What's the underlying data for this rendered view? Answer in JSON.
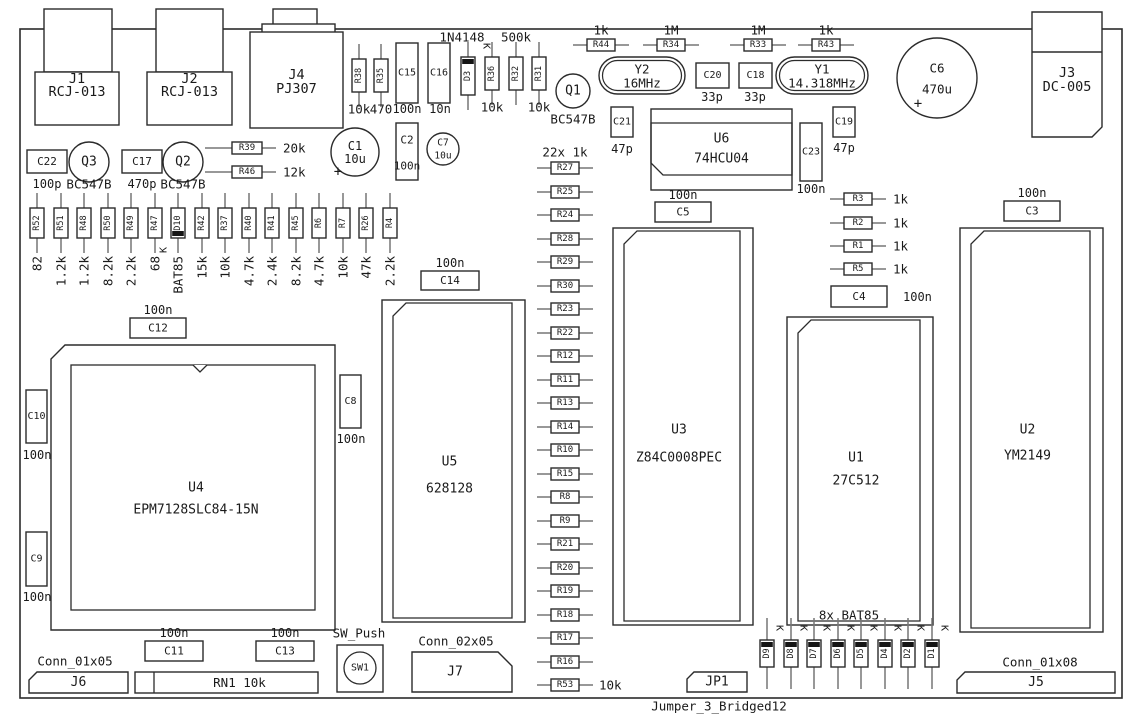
{
  "diagram_title": "PCB assembly drawing",
  "symbols": {
    "cathode": "K",
    "plus": "+"
  },
  "board": {
    "x": 20,
    "y": 29,
    "w": 1102,
    "h": 669
  },
  "notes": [
    {
      "x": 565,
      "y": 152,
      "t": "22x 1k"
    },
    {
      "x": 849,
      "y": 615,
      "t": "8x BAT85"
    },
    {
      "x": 359,
      "y": 633,
      "t": "SW_Push"
    },
    {
      "x": 75,
      "y": 661,
      "t": "Conn_01x05"
    },
    {
      "x": 456,
      "y": 641,
      "t": "Conn_02x05"
    },
    {
      "x": 1040,
      "y": 662,
      "t": "Conn_01x08"
    },
    {
      "x": 719,
      "y": 706,
      "t": "Jumper_3_Bridged12"
    }
  ],
  "components": [
    {
      "t": "ich",
      "ref": "U6",
      "val": "74HCU04",
      "x": 651,
      "y": 109,
      "w": 141,
      "h": 81,
      "iy1": 123,
      "iy2": 175,
      "ry": 139,
      "vy": 159
    },
    {
      "t": "icv",
      "ref": "U3",
      "val": "Z84C0008PEC",
      "x": 613,
      "y": 228,
      "w": 140,
      "h": 397,
      "ry": 430,
      "vy": 458
    },
    {
      "t": "icv",
      "ref": "U1",
      "val": "27C512",
      "x": 787,
      "y": 317,
      "w": 146,
      "h": 308,
      "ry": 458,
      "vy": 481
    },
    {
      "t": "icv",
      "ref": "U2",
      "val": "YM2149",
      "x": 960,
      "y": 228,
      "w": 143,
      "h": 404,
      "ry": 430,
      "vy": 456
    },
    {
      "t": "icv",
      "ref": "U5",
      "val": "628128",
      "x": 382,
      "y": 300,
      "w": 143,
      "h": 322,
      "ry": 462,
      "vy": 489
    },
    {
      "t": "plcc",
      "ref": "U4",
      "val": "EPM7128SLC84-15N",
      "x": 51,
      "y": 345,
      "w": 284,
      "h": 285,
      "ry": 488,
      "vy": 510
    },
    {
      "t": "rcj",
      "ref": "J1",
      "val": "RCJ-013",
      "tab": [
        44,
        9,
        68,
        63
      ],
      "body": [
        35,
        72,
        84,
        53
      ],
      "ry": 79,
      "vy": 92
    },
    {
      "t": "rcj",
      "ref": "J2",
      "val": "RCJ-013",
      "tab": [
        156,
        9,
        67,
        63
      ],
      "body": [
        147,
        72,
        85,
        53
      ],
      "ry": 79,
      "vy": 92
    },
    {
      "t": "pj",
      "ref": "J4",
      "val": "PJ307",
      "tab": [
        273,
        9,
        44,
        16
      ],
      "flange": [
        262,
        24,
        73,
        9
      ],
      "body": [
        250,
        32,
        93,
        96
      ],
      "ry": 75,
      "vy": 89
    },
    {
      "t": "dcj",
      "ref": "J3",
      "val": "DC-005",
      "x": 1032,
      "y": 12,
      "w": 70,
      "h": 125,
      "div": 52,
      "ry": 73,
      "vy": 87
    },
    {
      "t": "xtal",
      "ref": "Y2",
      "val": "16MHz",
      "x": 599,
      "y": 57,
      "w": 86,
      "h": 37
    },
    {
      "t": "xtal",
      "ref": "Y1",
      "val": "14.318MHz",
      "x": 776,
      "y": 57,
      "w": 92,
      "h": 37
    },
    {
      "t": "tr",
      "ref": "Q1",
      "val": "BC547B",
      "cx": 573,
      "cy": 91,
      "r": 17,
      "vy": 119
    },
    {
      "t": "tr",
      "ref": "Q3",
      "val": "BC547B",
      "cx": 89,
      "cy": 162,
      "r": 20,
      "vy": 184
    },
    {
      "t": "tr",
      "ref": "Q2",
      "val": "BC547B",
      "cx": 183,
      "cy": 162,
      "r": 20,
      "vy": 184
    },
    {
      "t": "ecap",
      "ref": "C1",
      "val": "10u",
      "cx": 355,
      "cy": 152,
      "r": 24,
      "fs": 12,
      "pp": [
        338,
        172
      ]
    },
    {
      "t": "ecap",
      "ref": "C7",
      "val": "10u",
      "cx": 443,
      "cy": 149,
      "r": 16,
      "fs": 9.5
    },
    {
      "t": "ecap",
      "ref": "C6",
      "val": "470u",
      "cx": 937,
      "cy": 78,
      "r": 40,
      "fs": 12.5,
      "dy": 11,
      "pp": [
        918,
        104
      ]
    },
    {
      "t": "cap",
      "ref": "C15",
      "val": "100n",
      "x": 396,
      "y": 43,
      "w": 22,
      "h": 60,
      "vx": 407,
      "vy": 109
    },
    {
      "t": "cap",
      "ref": "C16",
      "val": "10n",
      "x": 428,
      "y": 43,
      "w": 22,
      "h": 60,
      "vx": 440,
      "vy": 109
    },
    {
      "t": "cap",
      "ref": "C22",
      "val": "100p",
      "x": 27,
      "y": 150,
      "w": 40,
      "h": 23,
      "vx": 47,
      "vy": 184
    },
    {
      "t": "cap",
      "ref": "C17",
      "val": "470p",
      "x": 122,
      "y": 150,
      "w": 40,
      "h": 23,
      "vx": 142,
      "vy": 184
    },
    {
      "t": "cap",
      "ref": "C20",
      "val": "33p",
      "x": 696,
      "y": 63,
      "w": 33,
      "h": 25,
      "vx": 712,
      "vy": 97
    },
    {
      "t": "cap",
      "ref": "C18",
      "val": "33p",
      "x": 739,
      "y": 63,
      "w": 33,
      "h": 25,
      "vx": 755,
      "vy": 97
    },
    {
      "t": "cap",
      "ref": "C21",
      "val": "47p",
      "x": 611,
      "y": 107,
      "w": 22,
      "h": 30,
      "vx": 622,
      "vy": 149
    },
    {
      "t": "cap",
      "ref": "C19",
      "val": "47p",
      "x": 833,
      "y": 107,
      "w": 22,
      "h": 30,
      "vx": 844,
      "vy": 148
    },
    {
      "t": "cap",
      "ref": "C23",
      "val": "100n",
      "x": 800,
      "y": 123,
      "w": 22,
      "h": 58,
      "vx": 811,
      "vy": 189
    },
    {
      "t": "cap",
      "ref": "C5",
      "val": "100n",
      "x": 655,
      "y": 202,
      "w": 56,
      "h": 20,
      "vx": 683,
      "vy": 195
    },
    {
      "t": "cap",
      "ref": "C3",
      "val": "100n",
      "x": 1004,
      "y": 201,
      "w": 56,
      "h": 20,
      "vx": 1032,
      "vy": 193
    },
    {
      "t": "cap",
      "ref": "C4",
      "val": "100n",
      "x": 831,
      "y": 286,
      "w": 56,
      "h": 21,
      "vx": 903,
      "vy": 297,
      "va": "s"
    },
    {
      "t": "cap",
      "ref": "C12",
      "val": "100n",
      "x": 130,
      "y": 318,
      "w": 56,
      "h": 20,
      "vx": 158,
      "vy": 310
    },
    {
      "t": "cap",
      "ref": "C14",
      "val": "100n",
      "x": 421,
      "y": 271,
      "w": 58,
      "h": 19,
      "vx": 450,
      "vy": 263
    },
    {
      "t": "cap",
      "ref": "C11",
      "val": "100n",
      "x": 145,
      "y": 641,
      "w": 58,
      "h": 20,
      "vx": 174,
      "vy": 633
    },
    {
      "t": "cap",
      "ref": "C13",
      "val": "100n",
      "x": 256,
      "y": 641,
      "w": 58,
      "h": 20,
      "vx": 285,
      "vy": 633
    },
    {
      "t": "cap",
      "ref": "C10",
      "val": "100n",
      "x": 26,
      "y": 390,
      "w": 21,
      "h": 53,
      "vx": 37,
      "vy": 455
    },
    {
      "t": "cap",
      "ref": "C9",
      "val": "100n",
      "x": 26,
      "y": 532,
      "w": 21,
      "h": 54,
      "vx": 37,
      "vy": 597
    },
    {
      "t": "cap",
      "ref": "C8",
      "val": "100n",
      "x": 340,
      "y": 375,
      "w": 21,
      "h": 53,
      "vx": 351,
      "vy": 439
    },
    {
      "t": "cap2",
      "ref": "C2",
      "val": "100n",
      "x": 396,
      "y": 123,
      "w": 22,
      "h": 57,
      "ry": 140,
      "vy": 166
    },
    {
      "t": "vres",
      "ref": "R38",
      "val": "10k",
      "cx": 359,
      "by": 59
    },
    {
      "t": "vres",
      "ref": "R35",
      "val": "470",
      "cx": 381,
      "by": 59
    },
    {
      "t": "vres",
      "ref": "R36",
      "val": "10k",
      "cx": 492,
      "by": 57
    },
    {
      "t": "vres",
      "ref": "R32",
      "val": "500k",
      "cx": 516,
      "by": 57,
      "va": "a",
      "vy": 37
    },
    {
      "t": "vres",
      "ref": "R31",
      "val": "10k",
      "cx": 539,
      "by": 57
    },
    {
      "t": "vdio",
      "ref": "D3",
      "val": "1N4148",
      "cx": 468,
      "by": 57,
      "h": 38,
      "band": "t",
      "va": "a",
      "vx": 462,
      "vy": 37,
      "k": [
        486,
        46,
        90
      ]
    },
    {
      "t": "hres",
      "ref": "R44",
      "val": "1k",
      "cx": 601,
      "cy": 45,
      "va": "a",
      "vy": 30
    },
    {
      "t": "hres",
      "ref": "R34",
      "val": "1M",
      "cx": 671,
      "cy": 45,
      "va": "a",
      "vy": 30
    },
    {
      "t": "hres",
      "ref": "R33",
      "val": "1M",
      "cx": 758,
      "cy": 45,
      "va": "a",
      "vy": 30
    },
    {
      "t": "hres",
      "ref": "R43",
      "val": "1k",
      "cx": 826,
      "cy": 45,
      "va": "a",
      "vy": 30
    },
    {
      "t": "hres",
      "ref": "R39",
      "val": "20k",
      "cx": 247,
      "cy": 148,
      "w": 30,
      "pl": 27,
      "va": "s",
      "vx": 283
    },
    {
      "t": "hres",
      "ref": "R46",
      "val": "12k",
      "cx": 247,
      "cy": 172,
      "w": 30,
      "pl": 27,
      "va": "s",
      "vx": 283
    },
    {
      "t": "hres",
      "ref": "R3",
      "val": "1k",
      "cx": 858,
      "cy": 199,
      "va": "s",
      "vx": 893
    },
    {
      "t": "hres",
      "ref": "R2",
      "val": "1k",
      "cx": 858,
      "cy": 223,
      "va": "s",
      "vx": 893
    },
    {
      "t": "hres",
      "ref": "R1",
      "val": "1k",
      "cx": 858,
      "cy": 246,
      "va": "s",
      "vx": 893
    },
    {
      "t": "hres",
      "ref": "R5",
      "val": "1k",
      "cx": 858,
      "cy": 269,
      "va": "s",
      "vx": 893
    },
    {
      "t": "vres",
      "ref": "R52",
      "val": "82",
      "cx": 37,
      "by": 208,
      "h": 30,
      "vrot": 1
    },
    {
      "t": "vres",
      "ref": "R51",
      "val": "1.2k",
      "cx": 61,
      "by": 208,
      "h": 30,
      "vrot": 1
    },
    {
      "t": "vres",
      "ref": "R48",
      "val": "1.2k",
      "cx": 84,
      "by": 208,
      "h": 30,
      "vrot": 1
    },
    {
      "t": "vres",
      "ref": "R50",
      "val": "8.2k",
      "cx": 108,
      "by": 208,
      "h": 30,
      "vrot": 1
    },
    {
      "t": "vres",
      "ref": "R49",
      "val": "2.2k",
      "cx": 131,
      "by": 208,
      "h": 30,
      "vrot": 1
    },
    {
      "t": "vres",
      "ref": "R47",
      "val": "68",
      "cx": 155,
      "by": 208,
      "h": 30,
      "vrot": 1
    },
    {
      "t": "vdio",
      "ref": "D10",
      "val": "BAT85",
      "cx": 178,
      "by": 208,
      "h": 30,
      "band": "b",
      "vrot": 1,
      "k": [
        164,
        250,
        -90
      ]
    },
    {
      "t": "vres",
      "ref": "R42",
      "val": "15k",
      "cx": 202,
      "by": 208,
      "h": 30,
      "vrot": 1
    },
    {
      "t": "vres",
      "ref": "R37",
      "val": "10k",
      "cx": 225,
      "by": 208,
      "h": 30,
      "vrot": 1
    },
    {
      "t": "vres",
      "ref": "R40",
      "val": "4.7k",
      "cx": 249,
      "by": 208,
      "h": 30,
      "vrot": 1
    },
    {
      "t": "vres",
      "ref": "R41",
      "val": "2.4k",
      "cx": 272,
      "by": 208,
      "h": 30,
      "vrot": 1
    },
    {
      "t": "vres",
      "ref": "R45",
      "val": "8.2k",
      "cx": 296,
      "by": 208,
      "h": 30,
      "vrot": 1
    },
    {
      "t": "vres",
      "ref": "R6",
      "val": "4.7k",
      "cx": 319,
      "by": 208,
      "h": 30,
      "vrot": 1
    },
    {
      "t": "vres",
      "ref": "R7",
      "val": "10k",
      "cx": 343,
      "by": 208,
      "h": 30,
      "vrot": 1
    },
    {
      "t": "vres",
      "ref": "R26",
      "val": "47k",
      "cx": 366,
      "by": 208,
      "h": 30,
      "vrot": 1
    },
    {
      "t": "vres",
      "ref": "R4",
      "val": "2.2k",
      "cx": 390,
      "by": 208,
      "h": 30,
      "vrot": 1
    },
    {
      "t": "hres",
      "ref": "R27",
      "cx": 565,
      "cy": 168
    },
    {
      "t": "hres",
      "ref": "R25",
      "cx": 565,
      "cy": 192
    },
    {
      "t": "hres",
      "ref": "R24",
      "cx": 565,
      "cy": 215
    },
    {
      "t": "hres",
      "ref": "R28",
      "cx": 565,
      "cy": 239
    },
    {
      "t": "hres",
      "ref": "R29",
      "cx": 565,
      "cy": 262
    },
    {
      "t": "hres",
      "ref": "R30",
      "cx": 565,
      "cy": 286
    },
    {
      "t": "hres",
      "ref": "R23",
      "cx": 565,
      "cy": 309
    },
    {
      "t": "hres",
      "ref": "R22",
      "cx": 565,
      "cy": 333
    },
    {
      "t": "hres",
      "ref": "R12",
      "cx": 565,
      "cy": 356
    },
    {
      "t": "hres",
      "ref": "R11",
      "cx": 565,
      "cy": 380
    },
    {
      "t": "hres",
      "ref": "R13",
      "cx": 565,
      "cy": 403
    },
    {
      "t": "hres",
      "ref": "R14",
      "cx": 565,
      "cy": 427
    },
    {
      "t": "hres",
      "ref": "R10",
      "cx": 565,
      "cy": 450
    },
    {
      "t": "hres",
      "ref": "R15",
      "cx": 565,
      "cy": 474
    },
    {
      "t": "hres",
      "ref": "R8",
      "cx": 565,
      "cy": 497
    },
    {
      "t": "hres",
      "ref": "R9",
      "cx": 565,
      "cy": 521
    },
    {
      "t": "hres",
      "ref": "R21",
      "cx": 565,
      "cy": 544
    },
    {
      "t": "hres",
      "ref": "R20",
      "cx": 565,
      "cy": 568
    },
    {
      "t": "hres",
      "ref": "R19",
      "cx": 565,
      "cy": 591
    },
    {
      "t": "hres",
      "ref": "R18",
      "cx": 565,
      "cy": 615
    },
    {
      "t": "hres",
      "ref": "R17",
      "cx": 565,
      "cy": 638
    },
    {
      "t": "hres",
      "ref": "R16",
      "cx": 565,
      "cy": 662
    },
    {
      "t": "hres",
      "ref": "R53",
      "val": "10k",
      "cx": 565,
      "cy": 685,
      "va": "s",
      "vx": 599
    },
    {
      "t": "vdio",
      "ref": "D9",
      "cx": 767,
      "by": 640,
      "h": 27,
      "band": "t",
      "pt": 22,
      "pb": 22,
      "k": [
        779,
        628,
        90
      ]
    },
    {
      "t": "vdio",
      "ref": "D8",
      "cx": 791,
      "by": 640,
      "h": 27,
      "band": "t",
      "pt": 22,
      "pb": 22,
      "k": [
        803,
        628,
        90
      ]
    },
    {
      "t": "vdio",
      "ref": "D7",
      "cx": 814,
      "by": 640,
      "h": 27,
      "band": "t",
      "pt": 22,
      "pb": 22,
      "k": [
        826,
        628,
        90
      ]
    },
    {
      "t": "vdio",
      "ref": "D6",
      "cx": 838,
      "by": 640,
      "h": 27,
      "band": "t",
      "pt": 22,
      "pb": 22,
      "k": [
        850,
        628,
        90
      ]
    },
    {
      "t": "vdio",
      "ref": "D5",
      "cx": 861,
      "by": 640,
      "h": 27,
      "band": "t",
      "pt": 22,
      "pb": 22,
      "k": [
        873,
        628,
        90
      ]
    },
    {
      "t": "vdio",
      "ref": "D4",
      "cx": 885,
      "by": 640,
      "h": 27,
      "band": "t",
      "pt": 22,
      "pb": 22,
      "k": [
        897,
        628,
        90
      ]
    },
    {
      "t": "vdio",
      "ref": "D2",
      "cx": 908,
      "by": 640,
      "h": 27,
      "band": "t",
      "pt": 22,
      "pb": 22,
      "k": [
        920,
        628,
        90
      ]
    },
    {
      "t": "vdio",
      "ref": "D1",
      "cx": 932,
      "by": 640,
      "h": 27,
      "band": "t",
      "pt": 22,
      "pb": 22,
      "k": [
        944,
        628,
        90
      ]
    },
    {
      "t": "connb",
      "ref": "J6",
      "x": 29,
      "y": 672,
      "w": 99,
      "h": 21,
      "ch": "tl",
      "chs": 8
    },
    {
      "t": "rn",
      "ref": "RN1 10k",
      "x": 135,
      "y": 672,
      "w": 183,
      "h": 21,
      "divx": 154
    },
    {
      "t": "sw",
      "ref": "SW1",
      "x": 337,
      "y": 645,
      "w": 46,
      "h": 47,
      "ccx": 360,
      "ccy": 668,
      "cr": 16
    },
    {
      "t": "connb",
      "ref": "J7",
      "x": 412,
      "y": 652,
      "w": 100,
      "h": 40,
      "ch": "tr",
      "chs": 14,
      "lx": -7
    },
    {
      "t": "connb",
      "ref": "JP1",
      "x": 687,
      "y": 672,
      "w": 60,
      "h": 20,
      "ch": "tl",
      "chs": 7
    },
    {
      "t": "connb",
      "ref": "J5",
      "x": 957,
      "y": 672,
      "w": 158,
      "h": 21,
      "ch": "tl",
      "chs": 8
    }
  ]
}
